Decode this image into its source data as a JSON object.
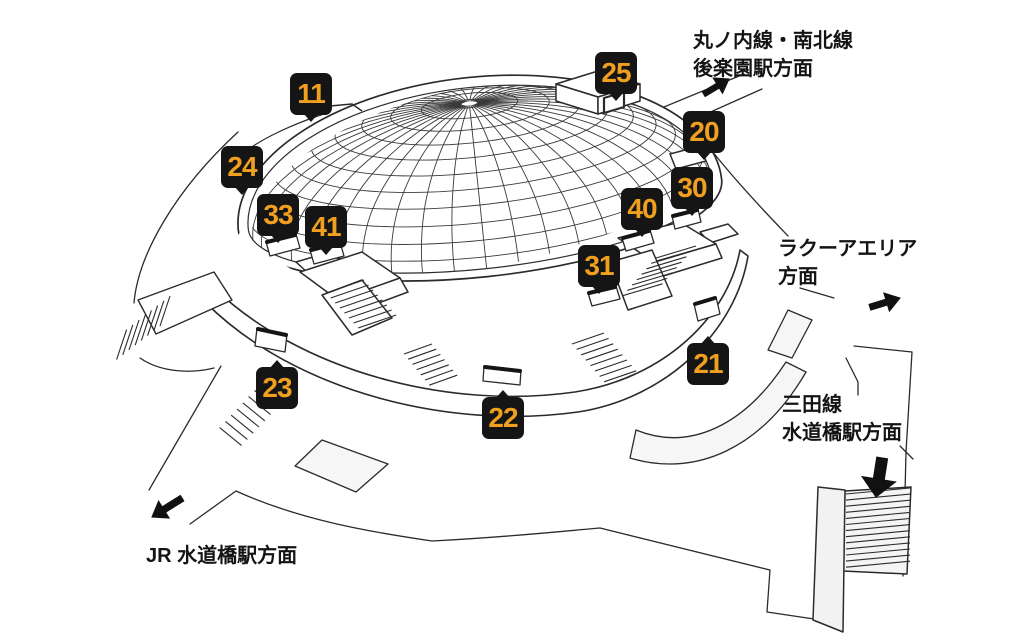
{
  "gates": [
    {
      "number": "11"
    },
    {
      "number": "25"
    },
    {
      "number": "20"
    },
    {
      "number": "24"
    },
    {
      "number": "30"
    },
    {
      "number": "33"
    },
    {
      "number": "40"
    },
    {
      "number": "41"
    },
    {
      "number": "31"
    },
    {
      "number": "21"
    },
    {
      "number": "23"
    },
    {
      "number": "22"
    }
  ],
  "labels": {
    "korakuen": {
      "line1": "丸ノ内線・南北線",
      "line2": "後楽園駅方面"
    },
    "laqua": {
      "line1": "ラクーアエリア",
      "line2": "方面"
    },
    "mita": {
      "line1": "三田線",
      "line2": "水道橋駅方面"
    },
    "jr": {
      "line1": "JR 水道橋駅方面"
    }
  },
  "icons": {
    "korakuen_arrow": "arrow-up-right",
    "laqua_arrow": "arrow-up-right",
    "mita_arrow": "arrow-down",
    "jr_arrow": "arrow-down-left"
  },
  "colors": {
    "background": "#ffffff",
    "badge_background": "#151515",
    "badge_number": "#F0A01E",
    "line_art": "#2b2b2b"
  }
}
